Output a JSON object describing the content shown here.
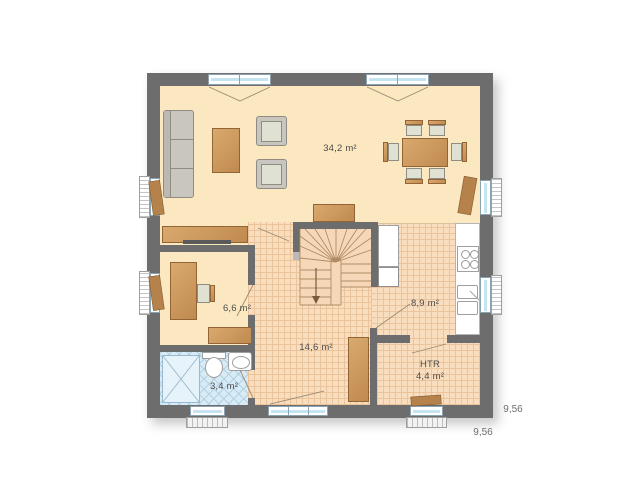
{
  "rooms": {
    "living_dining": {
      "area_label": "34,2 m²"
    },
    "office": {
      "area_label": "6,6 m²"
    },
    "hallway": {
      "area_label": "14,6 m²"
    },
    "kitchen": {
      "area_label": "8,9 m²"
    },
    "bathroom": {
      "area_label": "3,4 m²"
    },
    "utility": {
      "name": "HTR",
      "area_label": "4,4 m²"
    }
  },
  "dimensions": {
    "right": "9,56",
    "bottom": "9,56"
  },
  "colors": {
    "wall": "#6d6d6d",
    "floor_cream": "#fbe7c0",
    "floor_tile": "#f8ddbe",
    "tile_line": "#ecc49c",
    "floor_stairs": "#f6d8b8",
    "floor_bath": "#d9ecf6",
    "bath_line": "#b2d2e4",
    "brown": "#c08a50",
    "brown_light": "#d9a96d",
    "brown_dark": "#936536",
    "gray_furn": "#c9c6bf",
    "gray_furn_dark": "#8f8c84",
    "seat": "#dfe2d2",
    "glass": "#c5e4f2",
    "frame": "#8ba2b0",
    "fixture_line": "#9f9f9f",
    "line": "#9b8468",
    "text": "#4d4d4d"
  }
}
